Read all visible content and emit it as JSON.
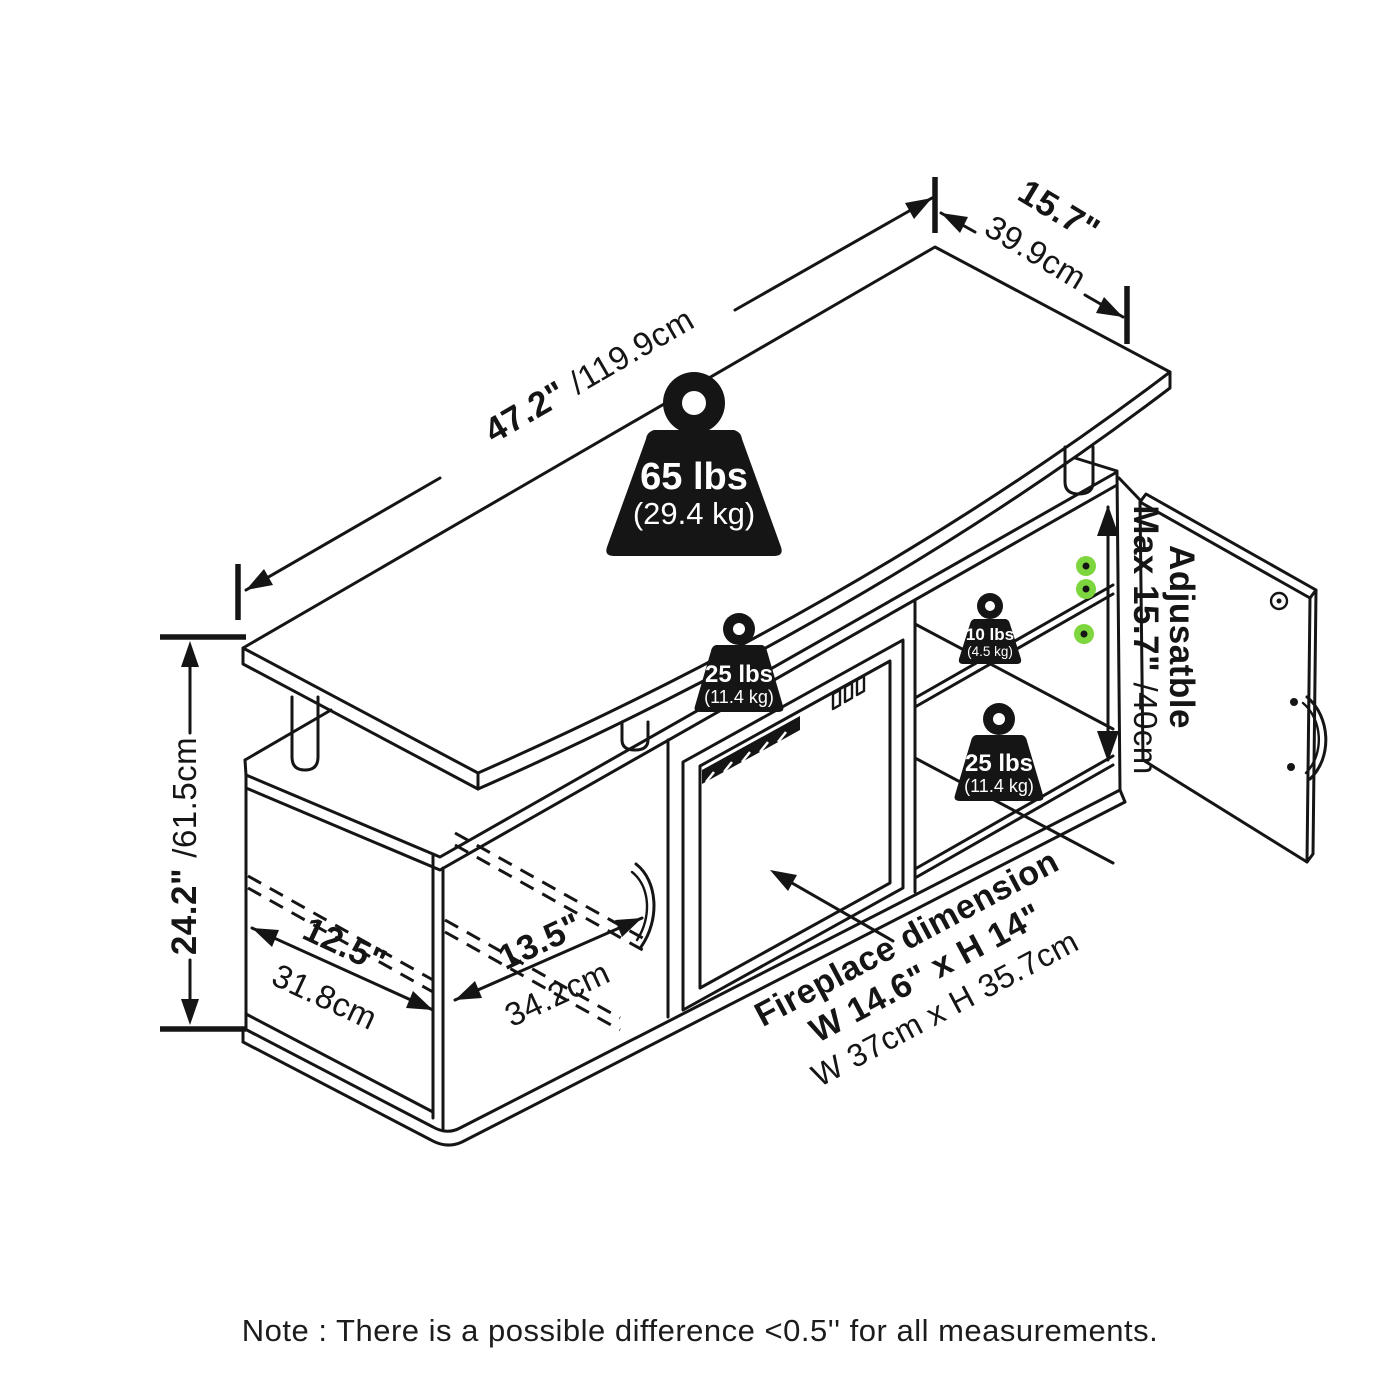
{
  "colors": {
    "ink": "#151515",
    "weight_fill": "#0b0b0b",
    "weight_text": "#ffffff",
    "pin_green": "#7ed63e",
    "background": "#ffffff"
  },
  "dimensions": {
    "top_width": {
      "inches": "47.2\" ",
      "cm": "/119.9cm"
    },
    "top_depth": {
      "inches": "15.7\"",
      "cm": "39.9cm"
    },
    "height": {
      "inches": "24.2\" ",
      "cm": "/61.5cm"
    },
    "left_door": {
      "inches": "12.5\"",
      "cm": "31.8cm"
    },
    "middle_door": {
      "inches": "13.5\"",
      "cm": "34.2cm"
    },
    "adjustable_shelf": {
      "line1": "Adjusatble",
      "line2_inches": "Max 15.7\" ",
      "line2_cm": "/40cm"
    }
  },
  "load_ratings": {
    "top_panel": {
      "lbs": "65 lbs",
      "kg": "(29.4 kg)"
    },
    "middle_shelf": {
      "lbs": "25 lbs",
      "kg": "(11.4 kg)"
    },
    "right_upper_shelf": {
      "lbs": "10 lbs",
      "kg": "(4.5 kg)"
    },
    "right_lower_shelf": {
      "lbs": "25 lbs",
      "kg": "(11.4 kg)"
    }
  },
  "fireplace": {
    "label_line1": "Fireplace dimension",
    "label_line2": "W 14.6\" x H 14\"",
    "label_line3": "W 37cm x H 35.7cm"
  },
  "note": "Note : There is a possible difference <0.5'' for all measurements."
}
